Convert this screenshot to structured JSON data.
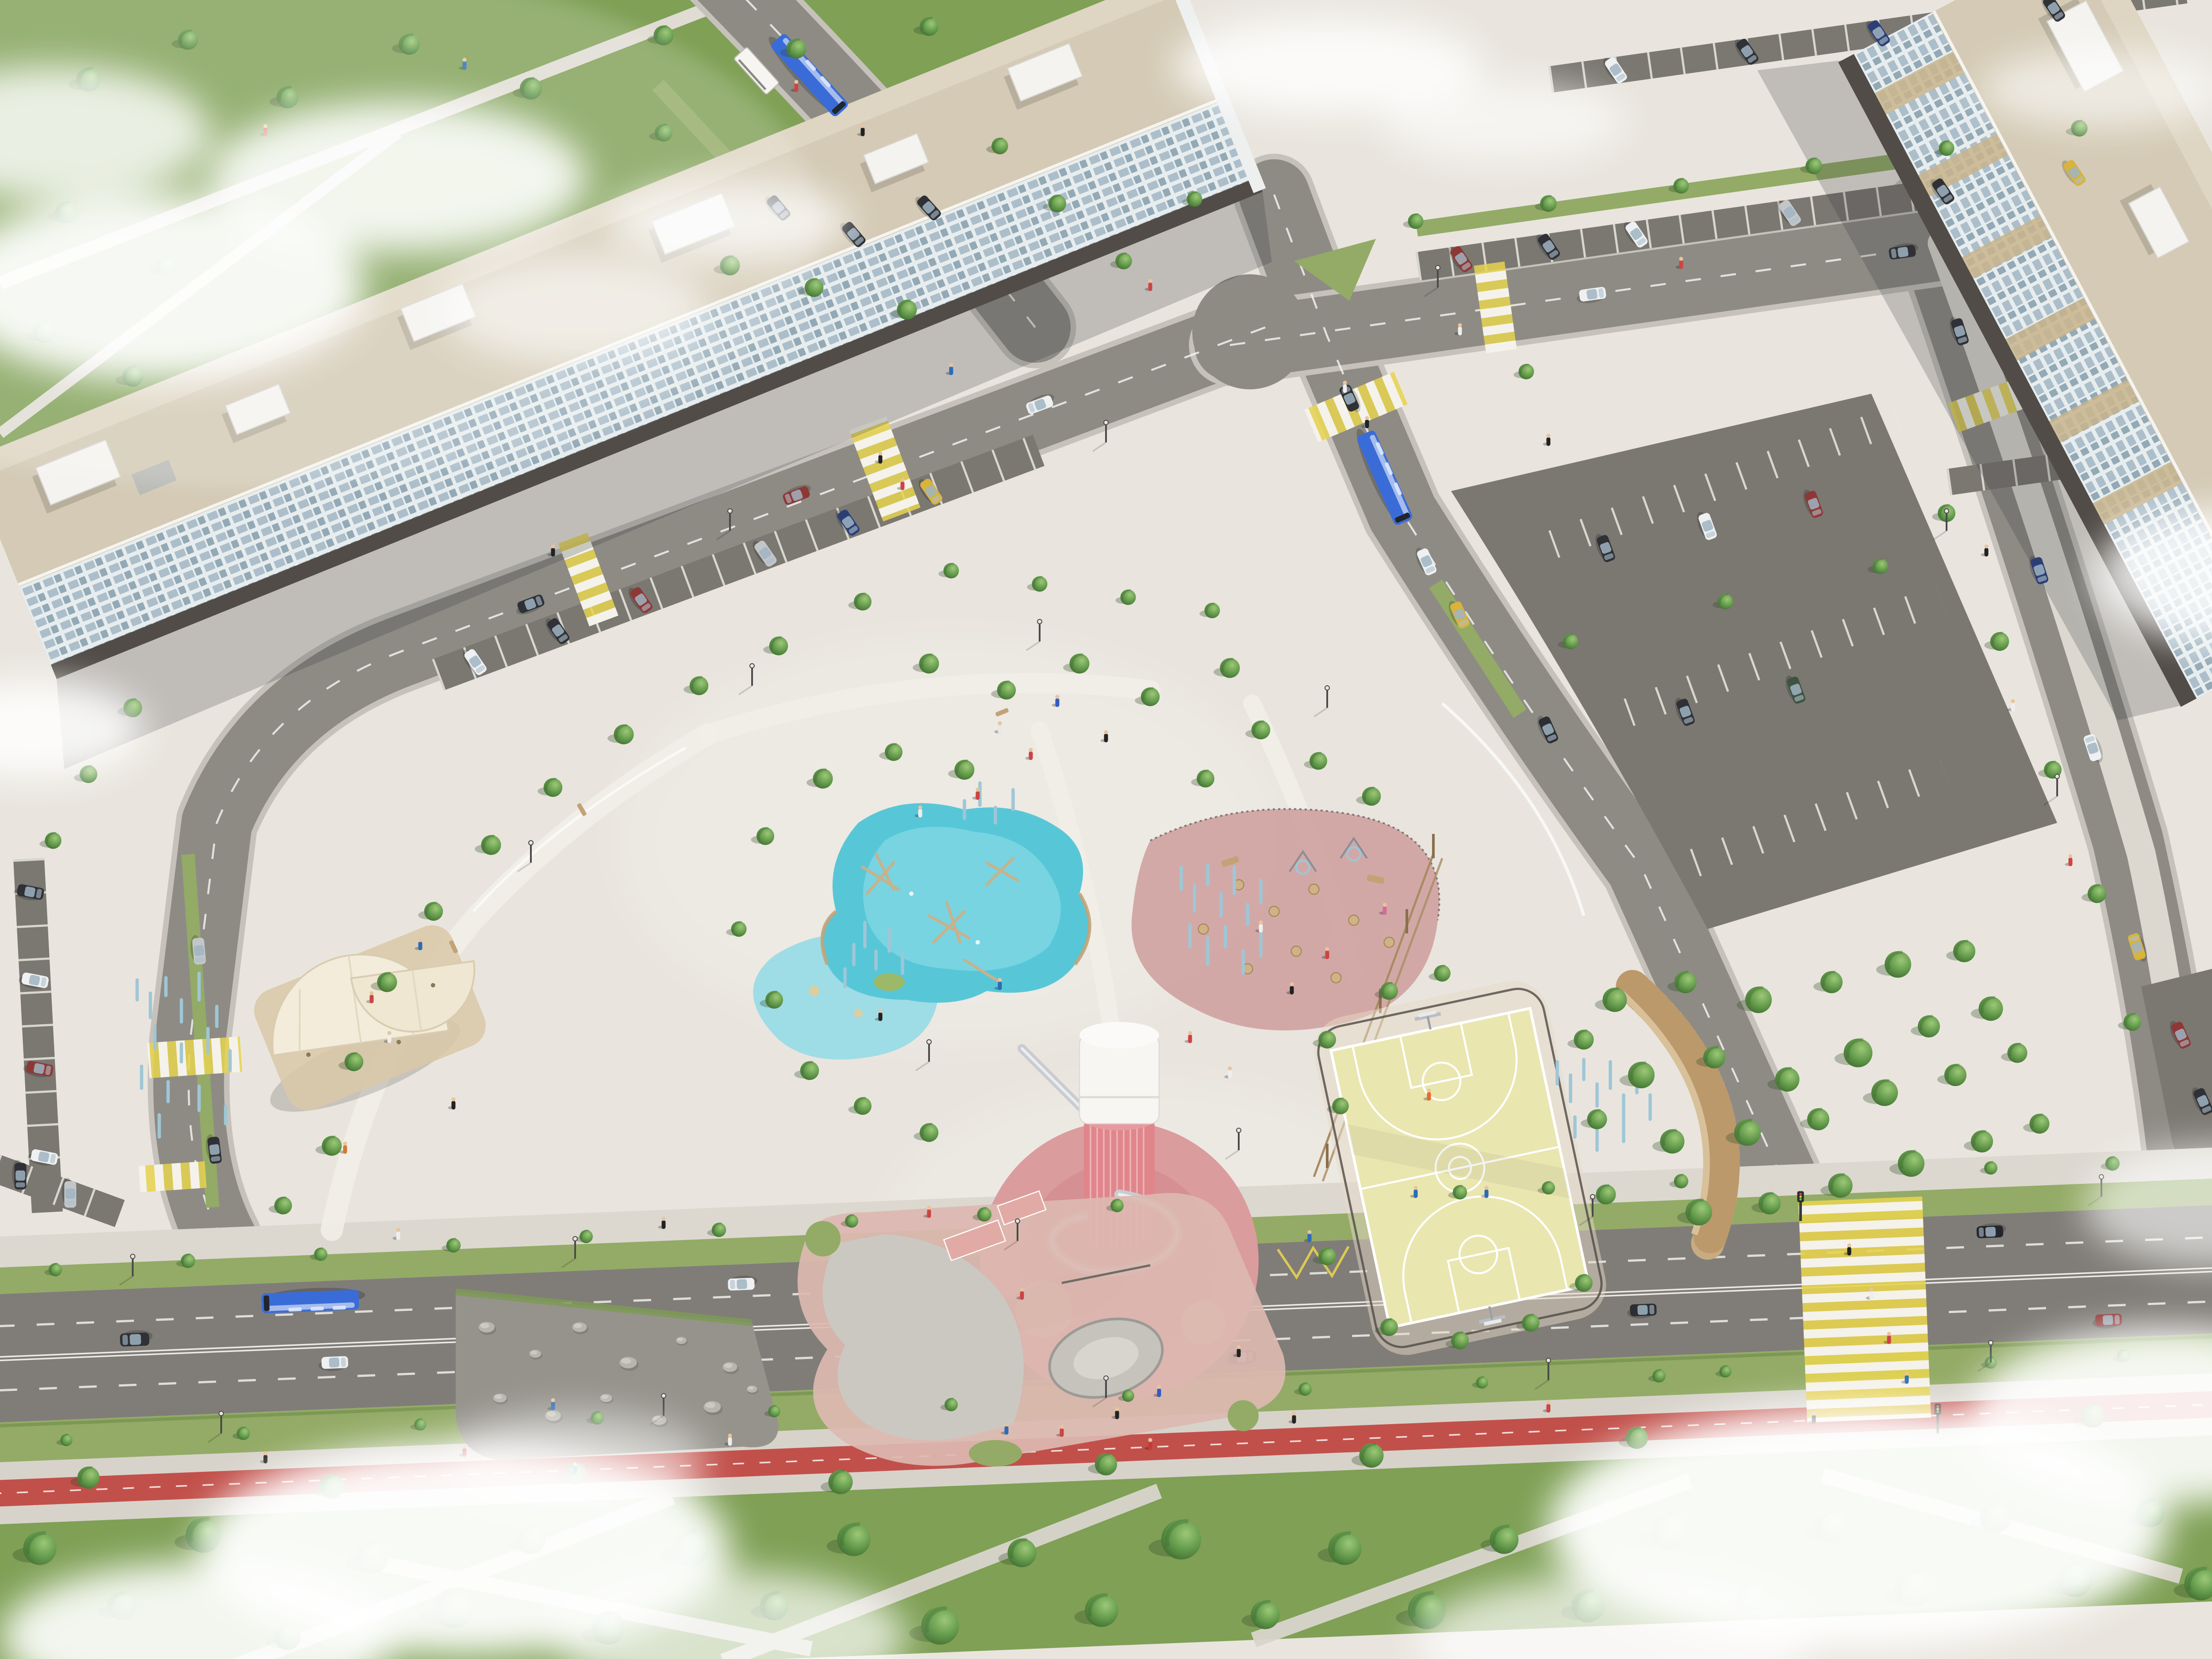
{
  "meta": {
    "title": "Aerial rendering of a new urban park with playgrounds between apartment blocks",
    "view": "oblique bird's-eye 3D visualization, daytime, scattered low clouds"
  },
  "colors": {
    "paving": "#e9e5de",
    "pavingLight": "#f1eee7",
    "sidewalk": "#dcd8d0",
    "road": "#8e8b85",
    "roadBlvd": "#807d78",
    "curb": "#c6c2bb",
    "lot": "#7b7771",
    "gravel": "#a59e95",
    "lawn": "#7fa055",
    "verge": "#93ab66",
    "water": "#57c7d8",
    "waterLight": "#8edce8",
    "splash": "#9adbe6",
    "kerbWood": "#c2a377",
    "towerWhite": "#f7f6f2",
    "towerPink": "#e0868b",
    "towerPad": "#db9c9e",
    "padInner": "#d48e90",
    "playPink": "#cfa3a2",
    "court": "#e9e6b0",
    "skatePink": "#dcb9b1",
    "concrete": "#cbc8c2",
    "wood": "#c8ab82",
    "woodDark": "#a8895c",
    "roofTan": "#d4cab5",
    "roofLight": "#ded5c2",
    "bldgFace": "#e7edee",
    "window": "#a9bcc8",
    "window2": "#8fa5b3",
    "baseDark": "#514c47",
    "bike": "#c2504a",
    "zebraY": "#e6d34f",
    "lineWhite": "#f7f6f2",
    "busBlue": "#3a6cd8",
    "taxi": "#d9b33a",
    "carWhite": "#eef0f1",
    "carRed": "#8e3835",
    "carBlue": "#2c3f74",
    "carSilver": "#c3c6c9",
    "carGreen": "#3c5340",
    "carDark": "#2f3136",
    "sticks": "#9fc6d6",
    "rock": "#b8b5ae",
    "cloud": "#ffffff"
  },
  "scene": {
    "park": {
      "features": [
        {
          "name": "water playground",
          "desc": "turquoise splash pond with timber climbing structures and an island"
        },
        {
          "name": "play tower with spiral slide",
          "desc": "white water-tower shaped tower on a pink lattice base over a pink circular surface"
        },
        {
          "name": "children's playground",
          "desc": "dusty-pink rubber surface with log stools, stumps and ring swings"
        },
        {
          "name": "basketball court",
          "desc": "pale yellow court with white markings, hoops and a low fence"
        },
        {
          "name": "skate park",
          "desc": "pink and grey concrete with ramps and a bowl"
        },
        {
          "name": "rock garden",
          "desc": "gravel bed with large grey boulders"
        },
        {
          "name": "pavilion",
          "desc": "two fan-shaped cream canopies on a timber deck"
        },
        {
          "name": "amphitheatre seating",
          "desc": "curved timber steps facing the court"
        },
        {
          "name": "art poles",
          "desc": "clusters of slender light-blue posts"
        },
        {
          "name": "rope course",
          "desc": "timber posts with elevated rope walk"
        }
      ]
    },
    "streets": {
      "features": [
        "yellow-and-white zebra crossings",
        "parallel and angled parking bays",
        "bus stops with white shelters and yellow zigzag markings",
        "red two-way cycle track along the boulevard",
        "tree-lined lawns and verges"
      ]
    },
    "buildings": [
      {
        "name": "west apartment block",
        "desc": "long light slab with glazed facade and tan gravel roof with white rooftop volumes"
      },
      {
        "name": "east apartment block",
        "desc": "light tower with tan pilaster stripes, corner of frame"
      }
    ],
    "vehicles": {
      "city_buses": 5,
      "cars": "about 35 incl. yellow taxis",
      "bus_color": "blue"
    },
    "people": "small figures walking on plazas, crossings and paths"
  }
}
